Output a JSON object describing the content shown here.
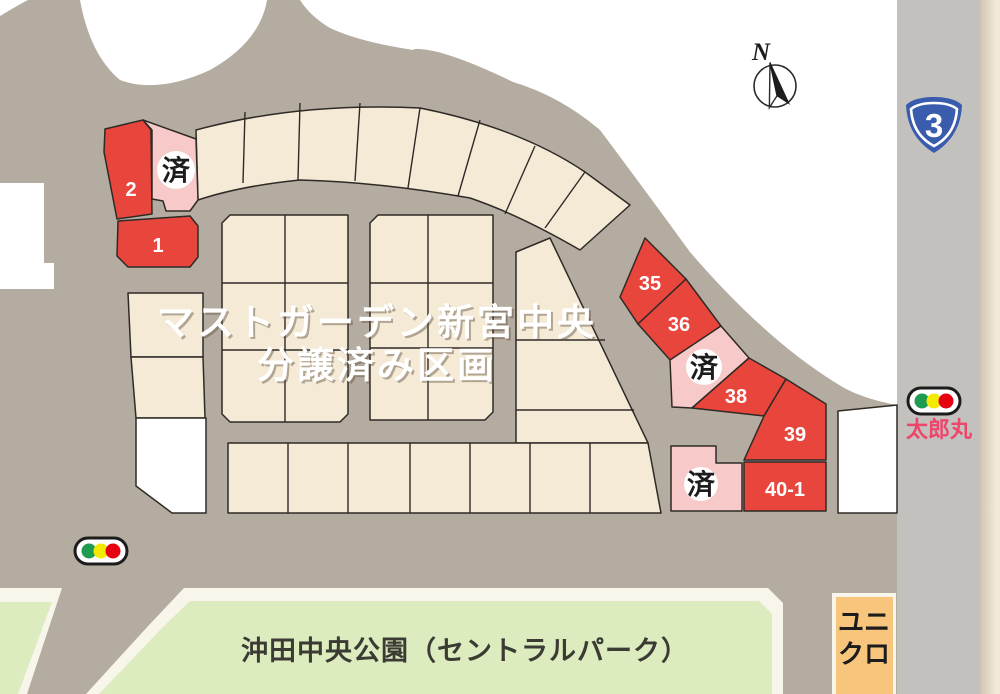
{
  "map": {
    "title_line1": "マストガーデン新宮中央",
    "title_line2": "分譲済み区画",
    "compass_label": "N",
    "route_sign_number": "3",
    "crossing_name": "太郎丸",
    "park_name": "沖田中央公園（セントラルパーク）",
    "store_name_line1": "ユニ",
    "store_name_line2": "クロ",
    "sold_mark": "済",
    "lots": {
      "lot1": {
        "label": "1"
      },
      "lot2": {
        "label": "2"
      },
      "lot35": {
        "label": "35"
      },
      "lot36": {
        "label": "36"
      },
      "lot38": {
        "label": "38"
      },
      "lot39": {
        "label": "39"
      },
      "lot40_1": {
        "label": "40-1"
      }
    },
    "colors": {
      "road": "#b5aca1",
      "highway_road": "#c2c1be",
      "lot_cream": "#f4ead6",
      "lot_red": "#e8453c",
      "lot_sold_pink": "#f7c9c8",
      "lot_white": "#ffffff",
      "park_green": "#dcecbe",
      "park_border": "#f8f5ea",
      "store_orange": "#f7c67c",
      "margin_beige": "#f1e9da",
      "route_sign_blue": "#3a5cad",
      "crossing_text": "#ef456a",
      "signal_green": "#209b52",
      "signal_yellow": "#f4e900",
      "signal_red": "#e50012",
      "outline": "#2e2a26"
    }
  }
}
